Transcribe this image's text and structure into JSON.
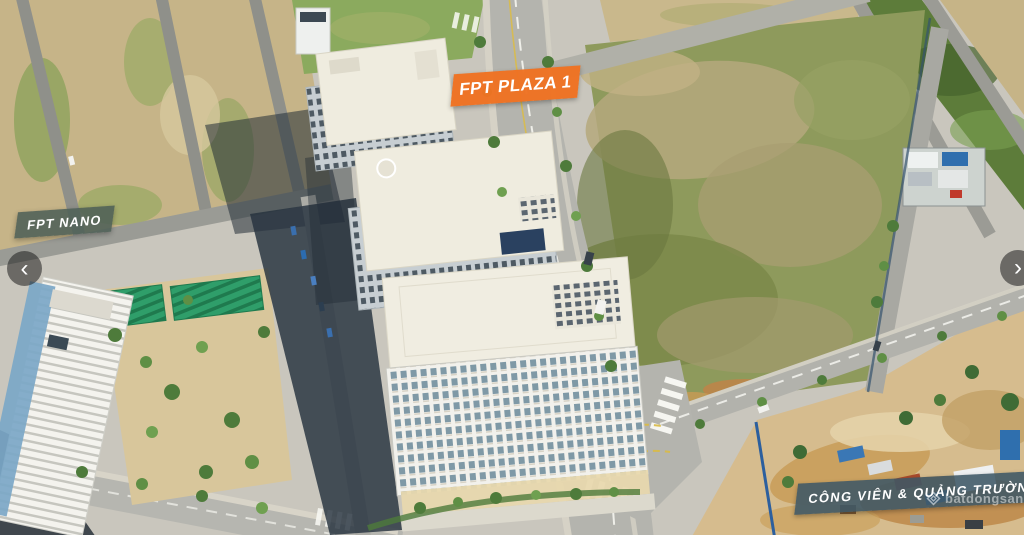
{
  "photo": {
    "description": "Aerial drone photo of FPT urban area: apartment towers, FPT Nano building, vacant grass field and construction site",
    "labels": {
      "plaza": {
        "text": "FPT PLAZA 1",
        "bg": "rgba(238,114,34,0.97)",
        "text_color": "#FFFFFF"
      },
      "nano": {
        "text": "FPT NANO",
        "bg": "rgba(79,96,87,0.88)",
        "text_color": "#FFFFFF"
      },
      "park": {
        "text": "CÔNG VIÊN & QUẢNG TRƯỜNG",
        "bg": "rgba(61,87,101,0.88)",
        "text_color": "#FFFFFF"
      }
    },
    "watermark": {
      "text": "batdongsan",
      "logo": "batdongsan-diamond-icon"
    }
  },
  "carousel": {
    "prev_label": "‹",
    "next_label": "›"
  }
}
